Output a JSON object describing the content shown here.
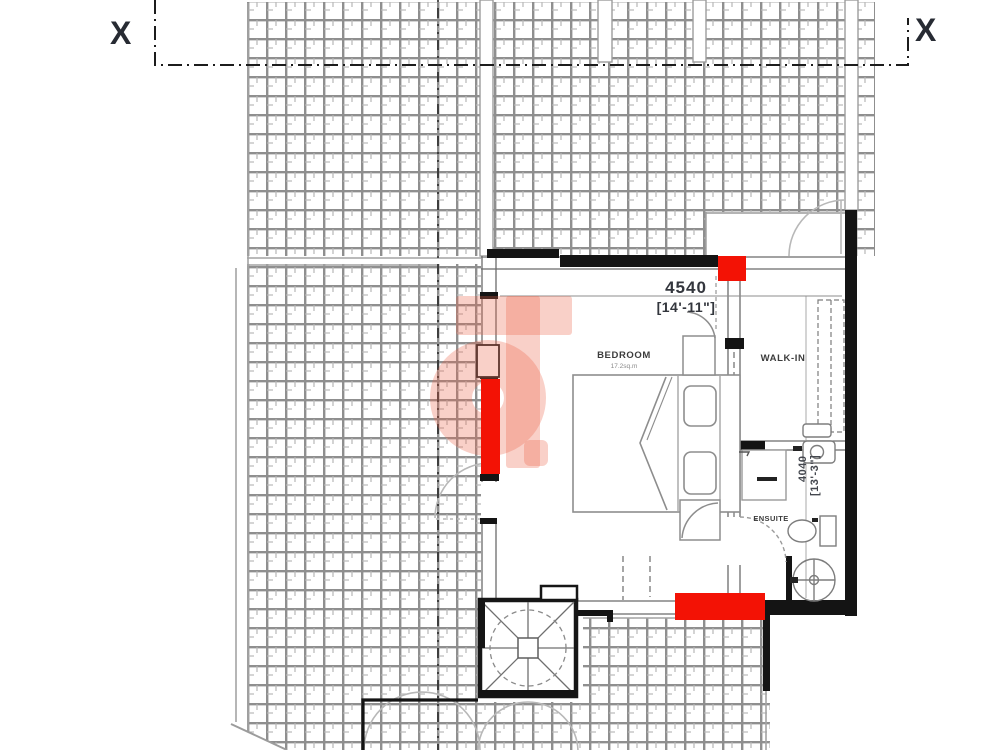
{
  "drawing": {
    "type": "architectural floor plan",
    "section_marker_left": "X",
    "section_marker_right": "X"
  },
  "rooms": {
    "bedroom": {
      "label": "BEDROOM",
      "area": "17.2sq.m"
    },
    "walk_in": {
      "label": "WALK-IN"
    },
    "ensuite": {
      "label": "ENSUITE"
    }
  },
  "dimensions": {
    "width": {
      "mm": "4540",
      "imperial": "[14'-11\"]"
    },
    "depth": {
      "mm": "4040",
      "imperial": "[13'-3\"]"
    }
  },
  "colors": {
    "highlight_red": "#f31205",
    "watermark": "#eb6548",
    "tile_line": "#8f8f8f",
    "wall_black": "#141414"
  },
  "icons": {
    "watermark_logo": "estate-agency-g-logo",
    "stair": "spiral-staircase",
    "drain": "floor-gully",
    "toilet": "wc",
    "bed": "double-bed"
  }
}
